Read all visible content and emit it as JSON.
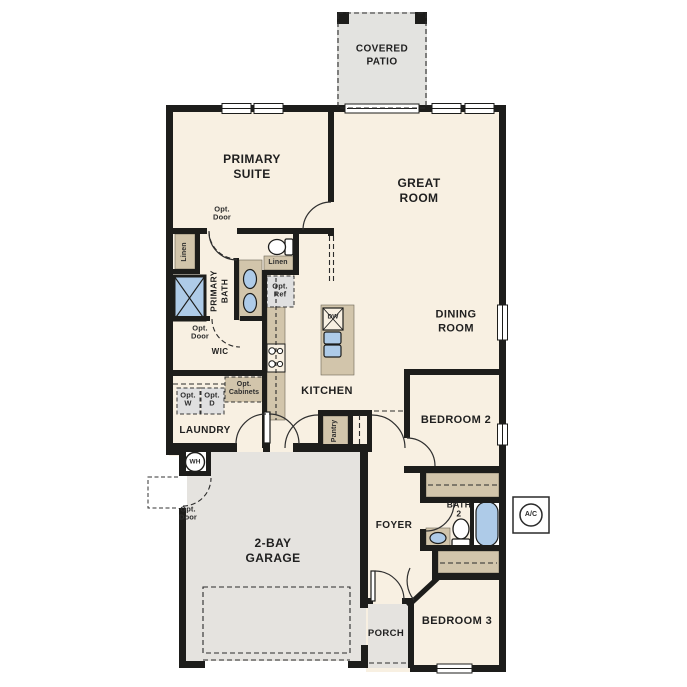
{
  "rooms": {
    "covered_patio": "COVERED\nPATIO",
    "primary_suite": "PRIMARY\nSUITE",
    "great_room": "GREAT\nROOM",
    "dining_room": "DINING\nROOM",
    "primary_bath": "PRIMARY\nBATH",
    "wic": "WIC",
    "kitchen": "KITCHEN",
    "laundry": "LAUNDRY",
    "bedroom_2": "BEDROOM 2",
    "bath_2": "BATH\n2",
    "foyer": "FOYER",
    "garage": "2-BAY\nGARAGE",
    "porch": "PORCH",
    "bedroom_3": "BEDROOM 3"
  },
  "annotations": {
    "opt_door": "Opt.\nDoor",
    "linen": "Linen",
    "opt_ref": "Opt.\nRef",
    "opt_w": "Opt.\nW",
    "opt_d": "Opt.\nD",
    "opt_cabinets": "Opt.\nCabinets",
    "pantry": "Pantry",
    "wh": "WH",
    "dw": "DW",
    "ac": "A/C"
  },
  "colors": {
    "wall": "#1d1d1b",
    "room_fill": "#f8f0e2",
    "garage_fill": "#e5e3df",
    "closet_fill": "#d2c5ab",
    "fixture_blue": "#aecbe8",
    "opt_fill": "#e0e0e0"
  }
}
